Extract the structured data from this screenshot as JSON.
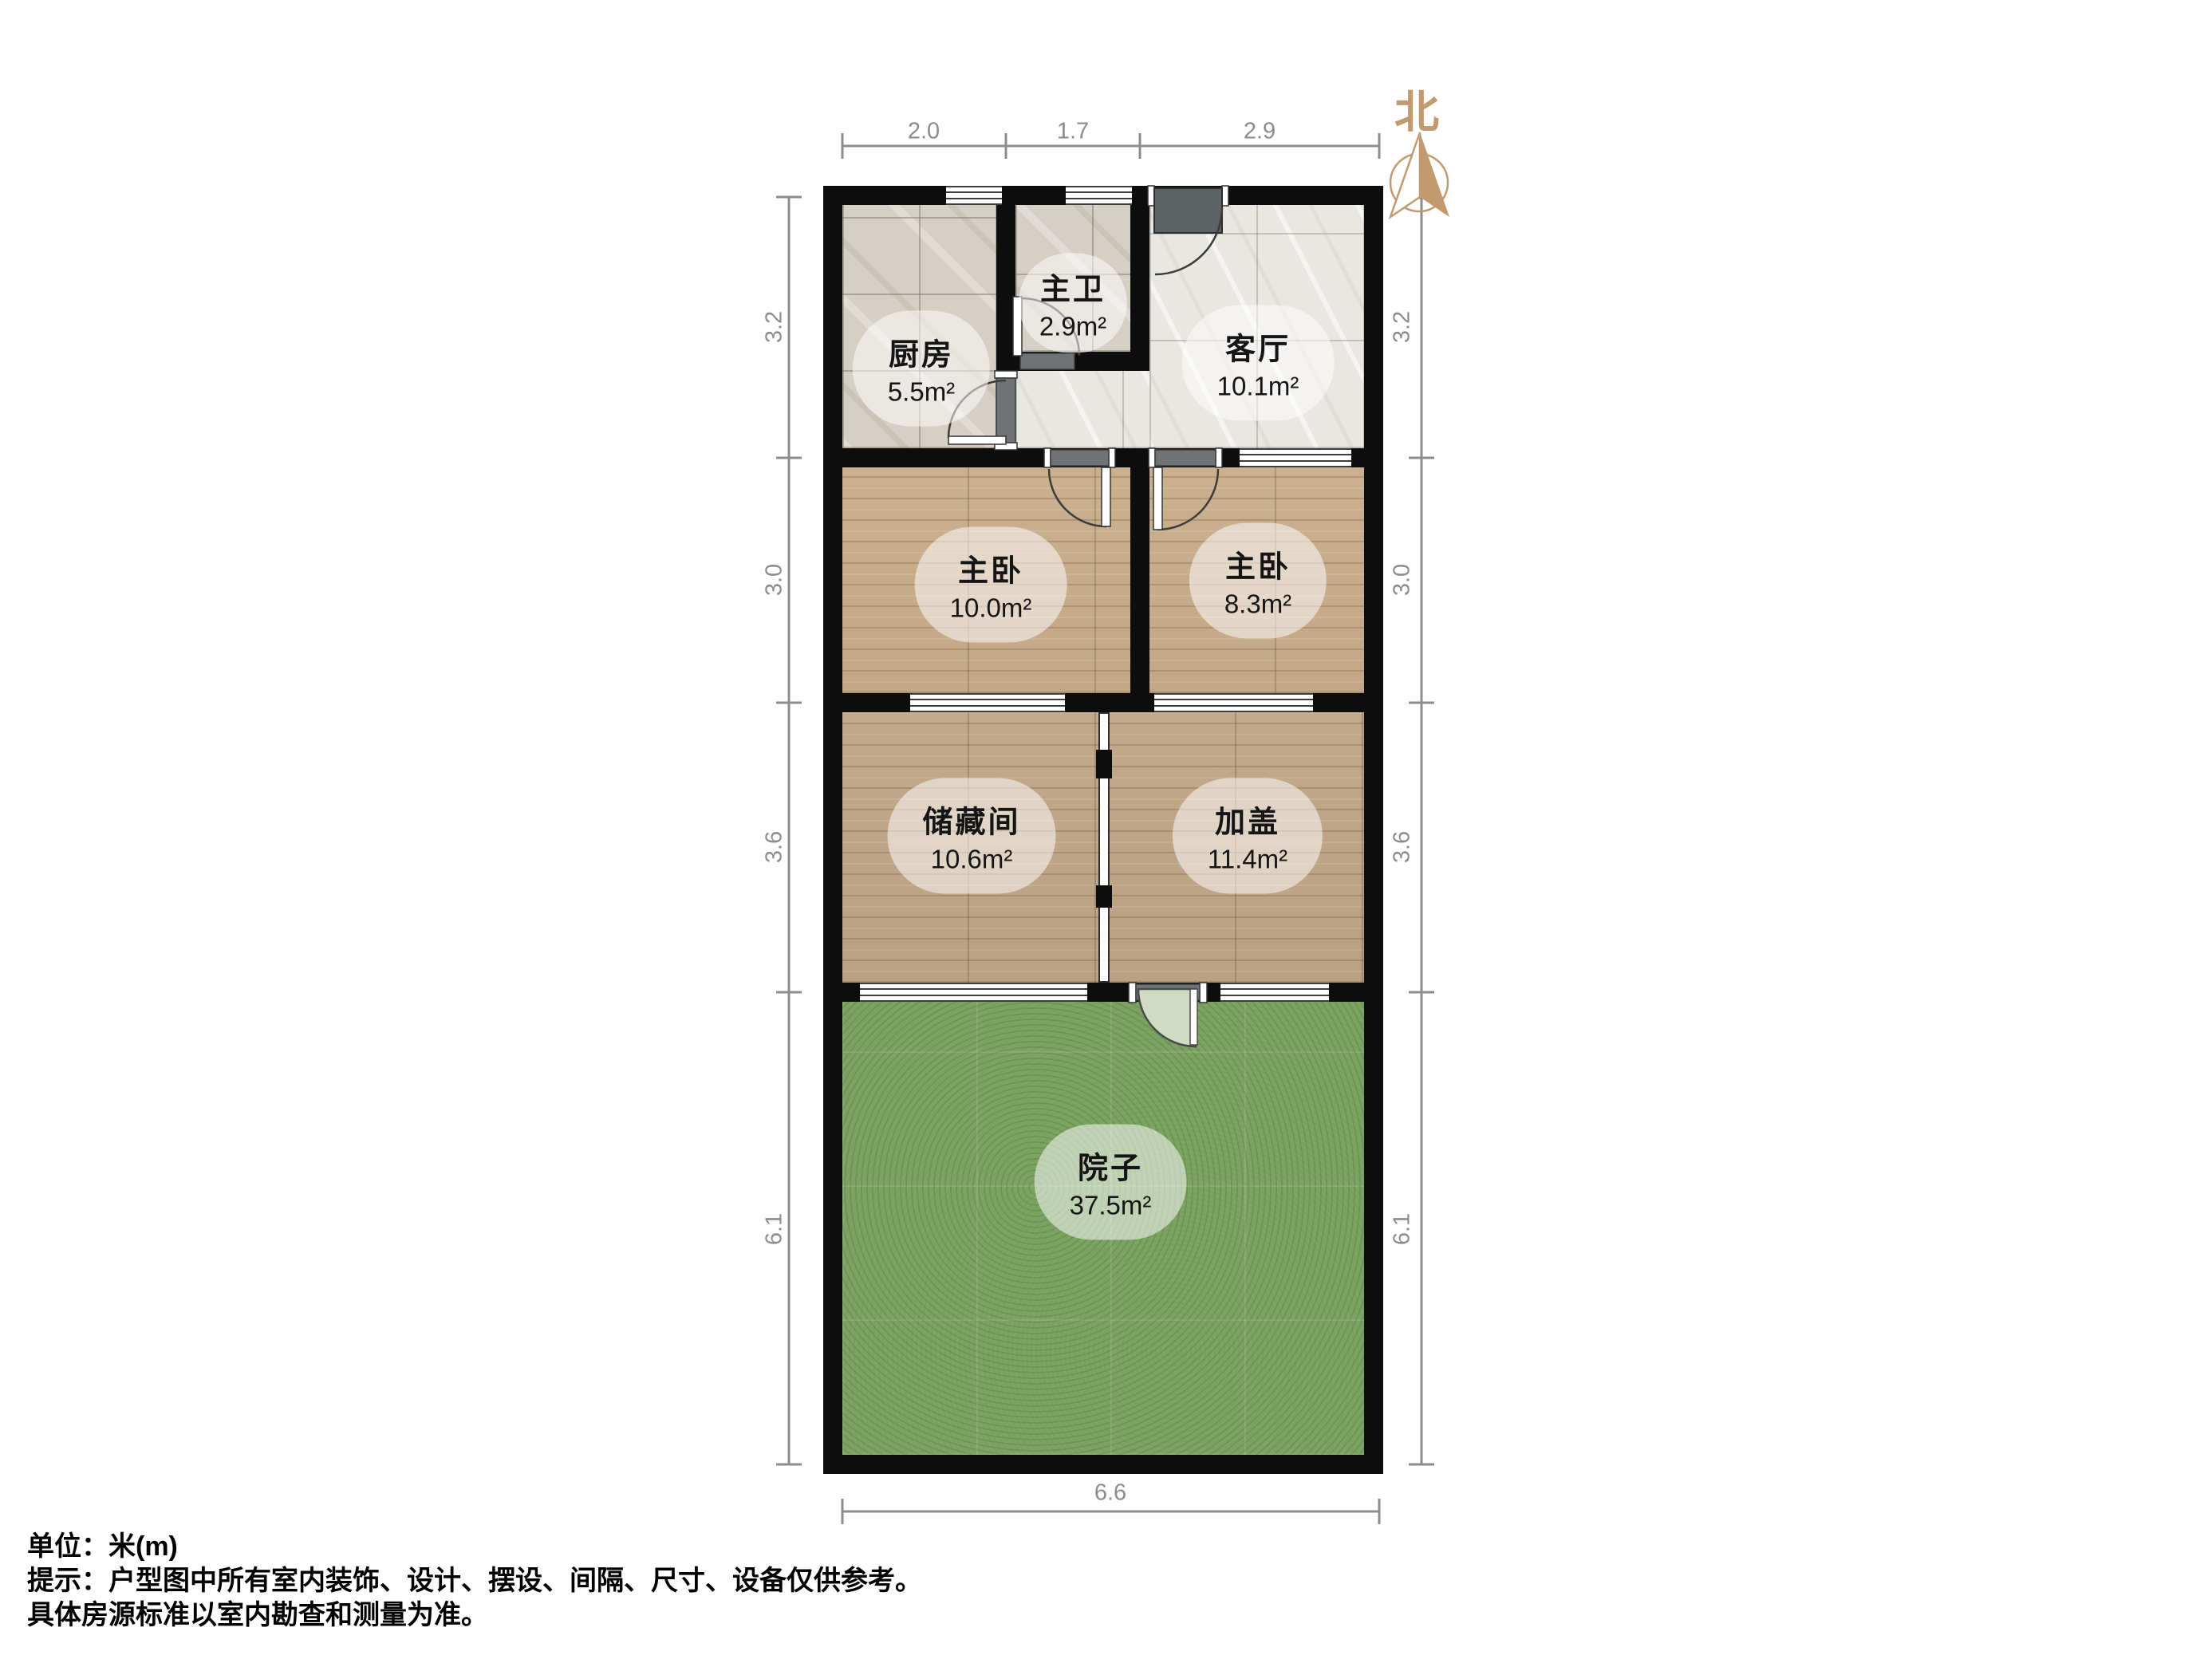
{
  "compass": {
    "label": "北"
  },
  "rooms": [
    {
      "id": "kitchen",
      "name": "厨房",
      "area": "5.5m²"
    },
    {
      "id": "bathroom",
      "name": "主卫",
      "area": "2.9m²"
    },
    {
      "id": "living",
      "name": "客厅",
      "area": "10.1m²"
    },
    {
      "id": "bedroom-left",
      "name": "主卧",
      "area": "10.0m²"
    },
    {
      "id": "bedroom-right",
      "name": "主卧",
      "area": "8.3m²"
    },
    {
      "id": "storage",
      "name": "储藏间",
      "area": "10.6m²"
    },
    {
      "id": "addition",
      "name": "加盖",
      "area": "11.4m²"
    },
    {
      "id": "yard",
      "name": "院子",
      "area": "37.5m²"
    }
  ],
  "dimensions": {
    "unit": "米(m)",
    "top": [
      "2.0",
      "1.7",
      "2.9"
    ],
    "left": [
      "3.2",
      "3.0",
      "3.6",
      "6.1"
    ],
    "right": [
      "3.2",
      "3.0",
      "3.6",
      "6.1"
    ],
    "bottom": [
      "6.6"
    ]
  },
  "footer": {
    "line1": "单位：米(m)",
    "line2": "提示：户型图中所有室内装饰、设计、摆设、间隔、尺寸、设备仅供参考。",
    "line3": "具体房源标准以室内勘查和测量为准。"
  },
  "colors": {
    "wall": "#0d0d0d",
    "compass": "#c39a6f",
    "dimension": "#8c8c8c",
    "grass": "#7da463",
    "wood": "#c6ac8d",
    "tile": "#d5cfc5",
    "marble": "#e9e7e2",
    "door_threshold": "#6f7374",
    "entry_door_panel": "#5d6264",
    "yard_door_leaf": "#cfdcc3"
  }
}
